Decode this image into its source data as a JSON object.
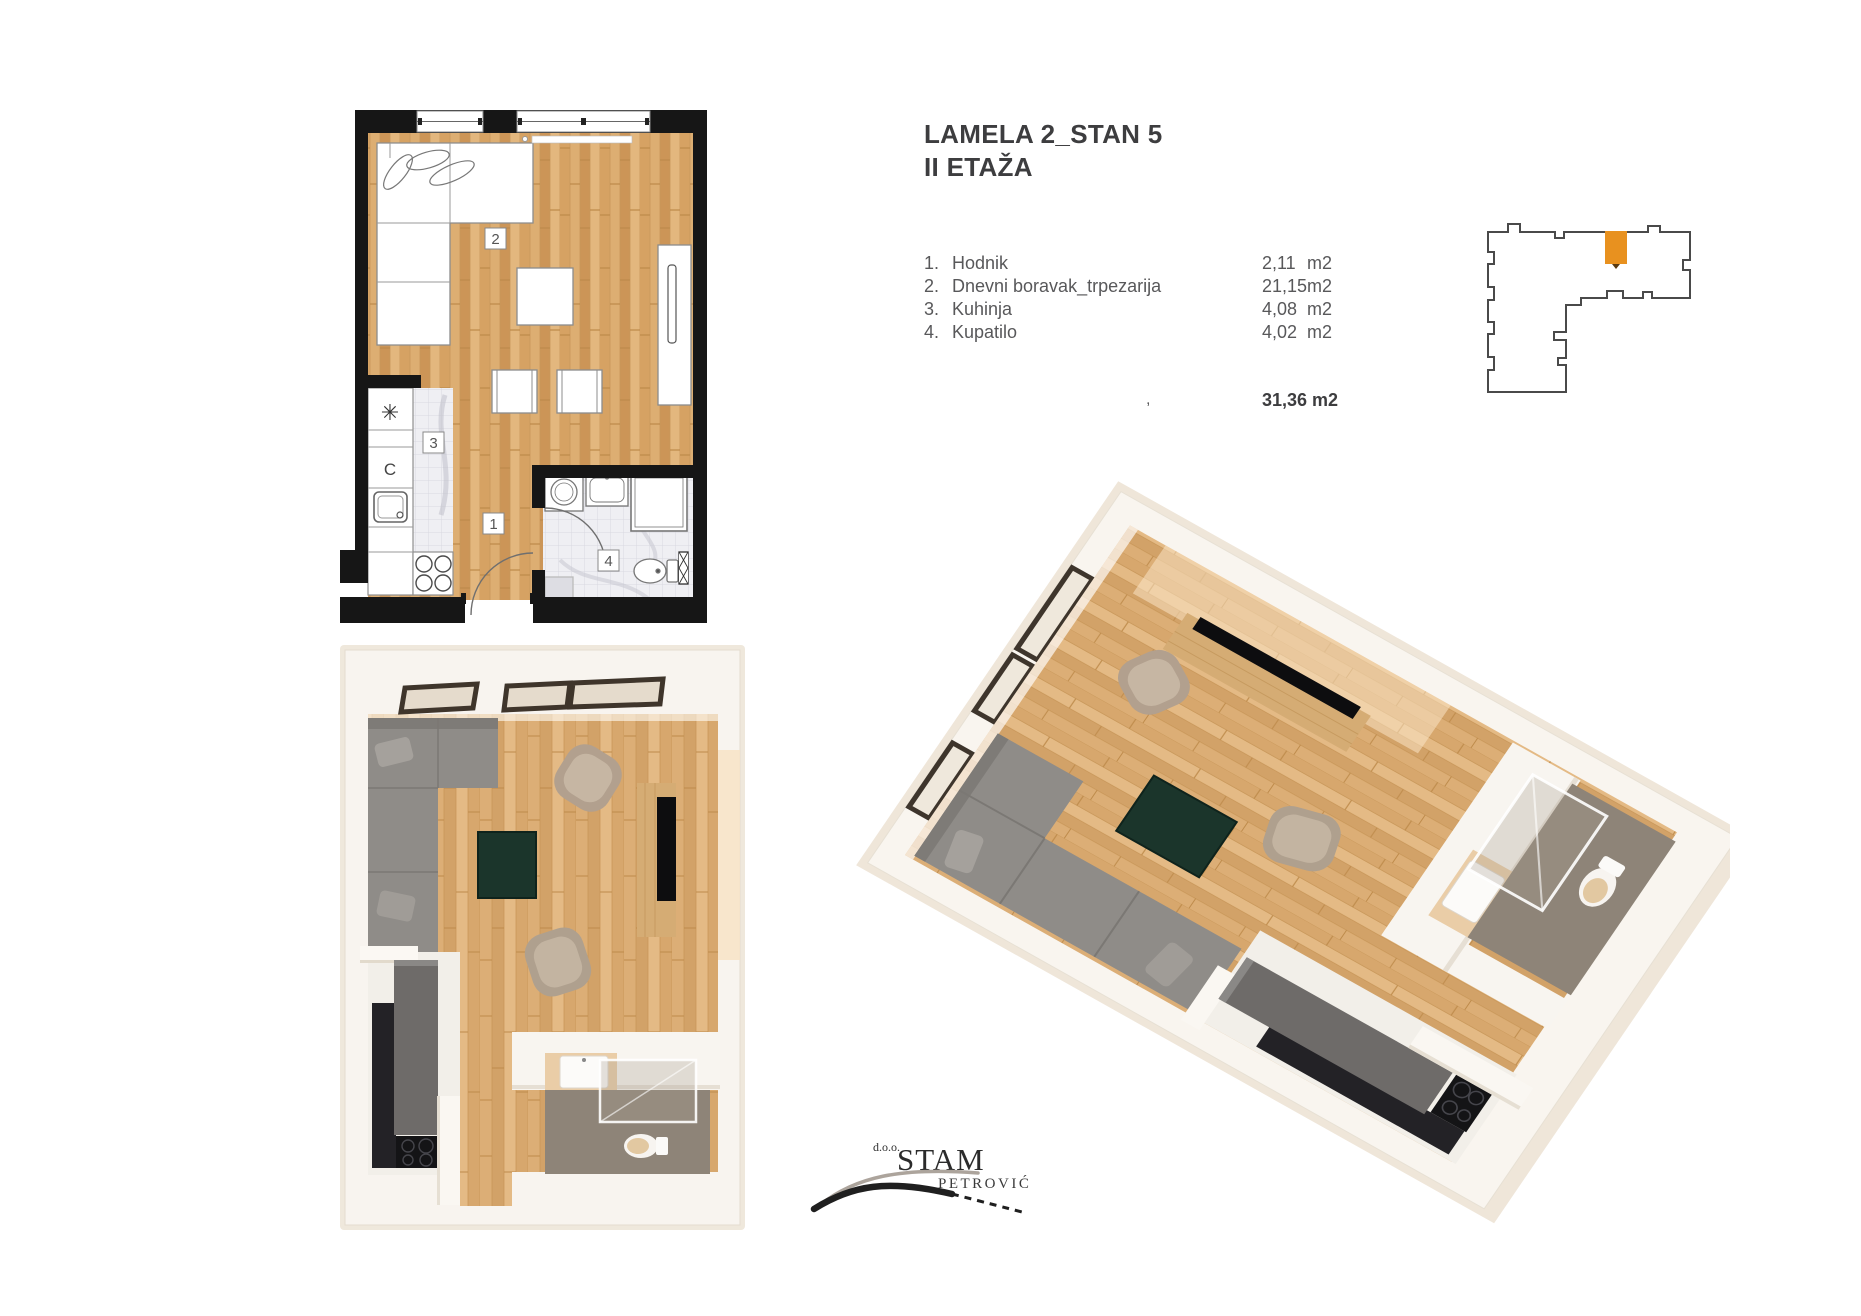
{
  "sheet": {
    "title_line1": "LAMELA 2_STAN 5",
    "title_line2": "II ETAŽA"
  },
  "rooms": {
    "items": [
      {
        "num": "1.",
        "name": "Hodnik",
        "area": "2,11",
        "unit": "m2"
      },
      {
        "num": "2.",
        "name": "Dnevni boravak_trpezarija",
        "area": "21,15",
        "unit": "m2"
      },
      {
        "num": "3.",
        "name": "Kuhinja",
        "area": "4,08",
        "unit": "m2"
      },
      {
        "num": "4.",
        "name": "Kupatilo",
        "area": "4,02",
        "unit": "m2"
      }
    ],
    "stray_comma": ",",
    "total": "31,36 m2"
  },
  "plan2d": {
    "labels": {
      "hall": "1",
      "living": "2",
      "kitchen": "3",
      "bath": "4"
    },
    "kitchen_symbols": {
      "fridge": "✳",
      "oven": "C"
    }
  },
  "locator": {
    "highlight_color": "#E8911F"
  },
  "logo": {
    "prefix": "d.o.o.",
    "name": "STAM",
    "surname": "PETROVIĆ"
  },
  "colors": {
    "accent_orange": "#E8911F",
    "wall_black": "#161616",
    "wood": "#D6A263",
    "render_wall": "#F8F4EF",
    "bath_floor": "#8E8478",
    "table_green": "#1B352B",
    "text_dark": "#3D3D3F",
    "text_gray": "#58585A"
  }
}
